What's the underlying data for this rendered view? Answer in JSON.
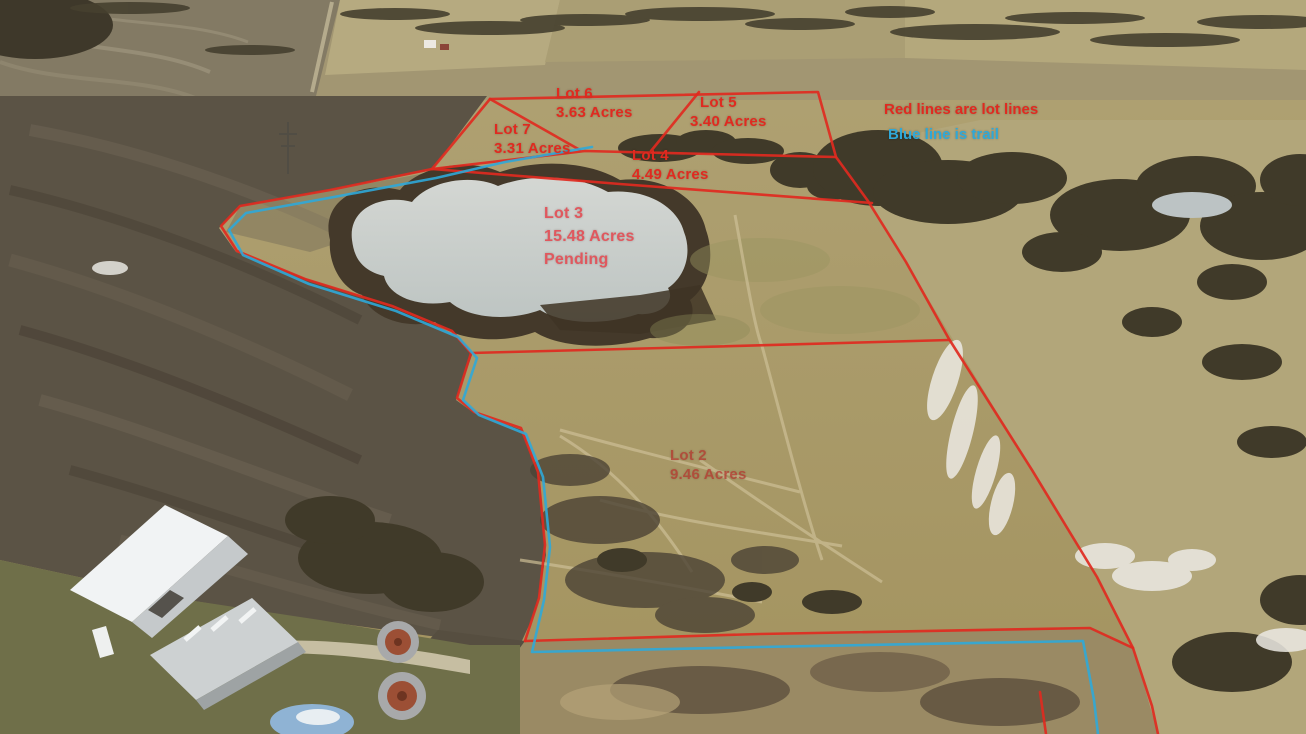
{
  "lots": {
    "lot7": {
      "name": "Lot 7",
      "acres": "3.31 Acres"
    },
    "lot6": {
      "name": "Lot 6",
      "acres": "3.63 Acres"
    },
    "lot5": {
      "name": "Lot 5",
      "acres": "3.40 Acres"
    },
    "lot4": {
      "name": "Lot 4",
      "acres": "4.49 Acres"
    },
    "lot3": {
      "name": "Lot 3",
      "acres": "15.48 Acres",
      "status": "Pending"
    },
    "lot2": {
      "name": "Lot 2",
      "acres": "9.46 Acres"
    }
  },
  "legend": {
    "red_note": "Red lines are lot lines",
    "blue_note": "Blue line is trail"
  },
  "colors": {
    "lot_line_red": "#e02a20",
    "trail_blue": "#2fa8d8"
  }
}
